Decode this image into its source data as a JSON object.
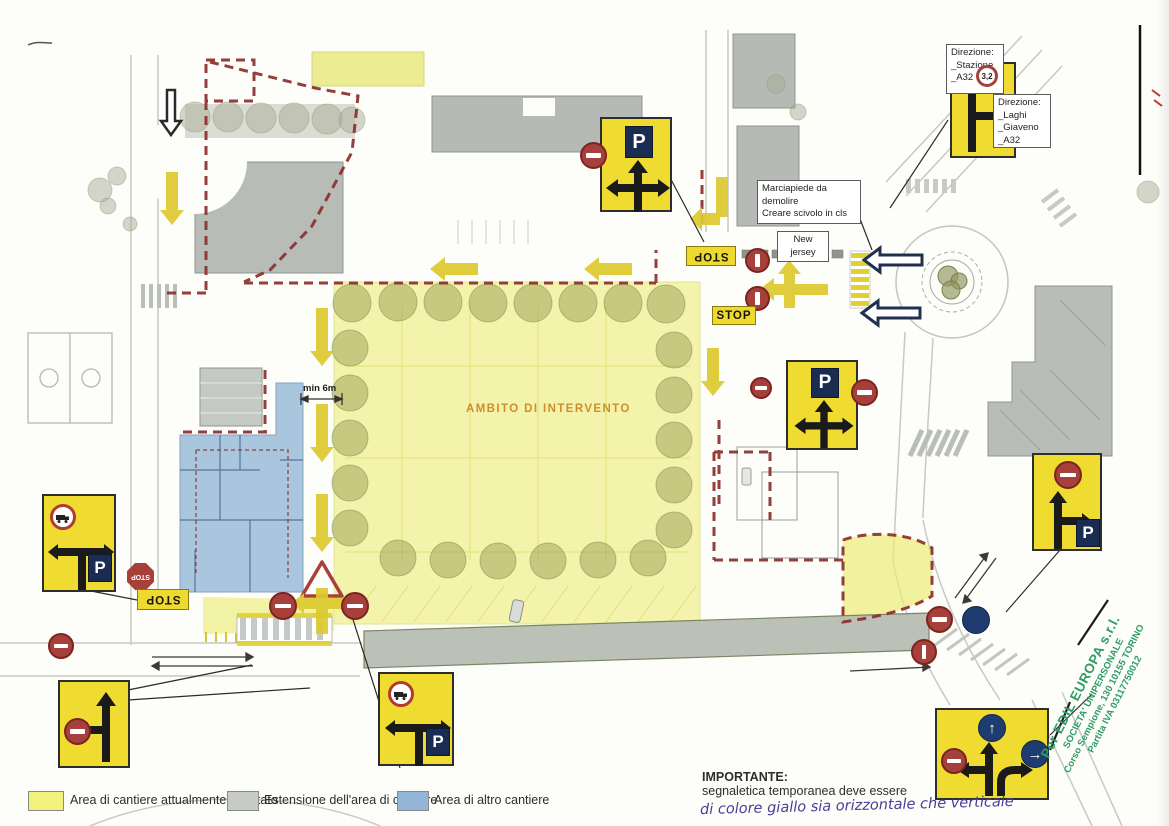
{
  "plan": {
    "area_label": "AMBITO DI INTERVENTO",
    "dimension_label": "min 6m",
    "stop_label": "STOP",
    "notes": {
      "marciapiede_line1": "Marciapiede da demolire",
      "marciapiede_line2": "Creare scivolo in cls",
      "new_jersey": "New jersey"
    }
  },
  "signs": {
    "direction_station": {
      "title": "Direzione:",
      "line1": "_Stazione",
      "line2": "_A32"
    },
    "direction_laghi": {
      "title": "Direzione:",
      "line1": "_Laghi",
      "line2": "_Giaveno",
      "line3": "_A32"
    }
  },
  "symbols": {
    "parking": "P",
    "width_limit": "3,2",
    "arrow_up": "↑",
    "arrow_right": "→"
  },
  "legend": {
    "items": [
      {
        "label": "Area di cantiere attualmente recintato",
        "color": "#f1f17c"
      },
      {
        "label": "Estensione dell'area di cantiere",
        "color": "#c6ccc4"
      },
      {
        "label": "Area di altro cantiere",
        "color": "#92b5d8"
      }
    ]
  },
  "note_importante": {
    "title": "IMPORTANTE:",
    "line1": "segnaletica temporanea deve essere",
    "line2": "di colore giallo sia orizzontale che verticale"
  },
  "stamp": {
    "line1": "Per EDIL EUROPA s.r.l.",
    "line2": "SOCIETA' UNIPERSONALE",
    "line3": "Corso Sempione, 130  10155 TORINO",
    "line4": "Partita IVA 03117750012",
    "color": "#2f9c62"
  },
  "colors": {
    "sign_yellow": "#f0dc30",
    "area_yellow": "#eded78",
    "extension_gray": "#b9beb4",
    "other_site_blue": "#8fb3d6",
    "boundary_dashed_red": "#8c2f2c",
    "no_entry_red": "#a6403a",
    "mandatory_blue": "#1f3c70",
    "handwriting_purple": "#4a3d99"
  }
}
